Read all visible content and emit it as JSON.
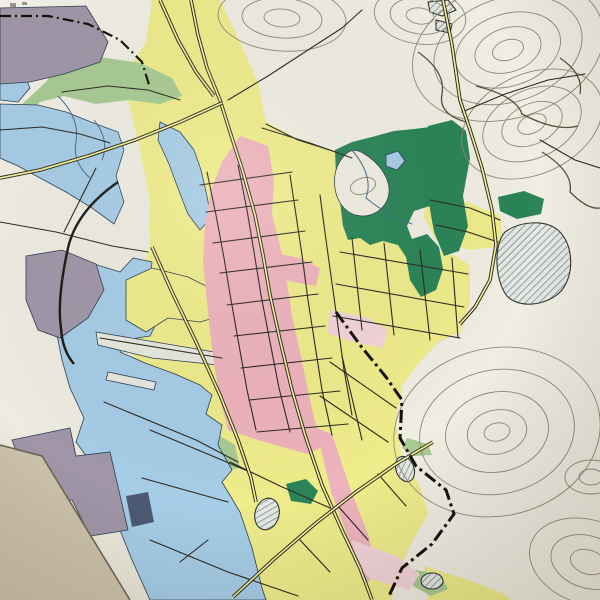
{
  "map": {
    "kind": "photographed paper city map (Japanese town plan)",
    "colors": {
      "paper": "#f0ede2",
      "residential_yellow": "#efec8b",
      "commercial_pink": "#eeb3bd",
      "faded_pink": "#f3d4da",
      "water_blue": "#a6cde7",
      "industrial_purple": "#a096a8",
      "dark_navy_block": "#4b5a72",
      "park_green": "#2a8457",
      "field_sage": "#a8cb92",
      "contour_grey": "#8d8a7a",
      "road_black": "#2b2820",
      "boundary_black": "#141208",
      "table_tan": "#cdc2ab",
      "grid_cyan": "#8fd2de",
      "label_ink": "#25221a"
    },
    "labels": [
      {
        "id": "ejiri-cho",
        "text": "江尻町",
        "x": 93,
        "y": 45,
        "dir": 7,
        "size": 12.5,
        "step": 22
      },
      {
        "id": "kendo-33",
        "text": "県道33",
        "x": 171,
        "y": 3,
        "dir": 38,
        "size": 8,
        "step": 8.5
      },
      {
        "id": "showa-cho",
        "text": "昭和町",
        "x": 107,
        "y": 170,
        "dir": -66,
        "size": 11.5,
        "step": 21
      },
      {
        "id": "yokotsu-cho",
        "text": "横津町",
        "x": 204,
        "y": 127,
        "dir": 55,
        "size": 11,
        "step": 12
      },
      {
        "id": "asahi-cho",
        "text": "旭町",
        "x": 211,
        "y": 164,
        "dir": 40,
        "size": 11,
        "step": 12
      },
      {
        "id": "tani-cho",
        "text": "谷町",
        "x": 267,
        "y": 148,
        "dir": 35,
        "size": 10.5,
        "step": 11
      },
      {
        "id": "kume-cho",
        "text": "久米町",
        "x": 172,
        "y": 246,
        "dir": -70,
        "size": 12,
        "step": 15
      },
      {
        "id": "muro-machi",
        "text": "室町",
        "x": 208,
        "y": 208,
        "dir": 25,
        "size": 9.5,
        "step": 10.5
      },
      {
        "id": "kyo-machi",
        "text": "京町",
        "x": 227,
        "y": 257,
        "dir": 30,
        "size": 11,
        "step": 12
      },
      {
        "id": "moto-machi",
        "text": "元町",
        "x": 258,
        "y": 298,
        "dir": 33,
        "size": 11,
        "step": 12
      },
      {
        "id": "hon-machi",
        "text": "本町",
        "x": 258,
        "y": 336,
        "dir": 31,
        "size": 11,
        "step": 12
      },
      {
        "id": "takara-machi",
        "text": "宝町",
        "x": 147,
        "y": 313,
        "dir": -8,
        "size": 10,
        "step": 12
      },
      {
        "id": "irifune-cho",
        "text": "入船町",
        "x": 127,
        "y": 324,
        "dir": -26,
        "size": 11.5,
        "step": 15
      },
      {
        "id": "chuo-cho",
        "text": "中央町",
        "x": 206,
        "y": 376,
        "dir": 76,
        "size": 12,
        "step": 15
      },
      {
        "id": "miyashita-cho",
        "text": "宮下町",
        "x": 253,
        "y": 421,
        "dir": 75,
        "size": 11.5,
        "step": 15
      },
      {
        "id": "shirogane-cho",
        "text": "白金町",
        "x": 296,
        "y": 443,
        "dir": 75,
        "size": 11.5,
        "step": 15
      },
      {
        "id": "bunkyo-cho",
        "text": "文京町",
        "x": 343,
        "y": 265,
        "dir": 75,
        "size": 11.5,
        "step": 14
      },
      {
        "id": "aoba-cho",
        "text": "青葉町",
        "x": 429,
        "y": 254,
        "dir": 78,
        "size": 10.5,
        "step": 13
      },
      {
        "id": "ikezono-cho",
        "text": "池園町",
        "x": 446,
        "y": 282,
        "dir": 78,
        "size": 9,
        "step": 10
      },
      {
        "id": "umee-cho",
        "text": "梅江町",
        "x": 437,
        "y": 186,
        "dir": -80,
        "size": 9.5,
        "step": 14
      },
      {
        "id": "oyabu-cho",
        "text": "大屋冨町",
        "x": 519,
        "y": 213,
        "dir": -110,
        "size": 10,
        "step": 15
      },
      {
        "id": "kamada-ike",
        "text": "鎌田池",
        "x": 525,
        "y": 241,
        "dir": 78,
        "size": 9.5,
        "step": 11,
        "halo": true
      },
      {
        "id": "fujimi-cho",
        "text": "富士見町",
        "x": 387,
        "y": 332,
        "dir": 80,
        "size": 11.5,
        "step": 13
      },
      {
        "id": "niihama-cho",
        "text": "新浜町",
        "x": 336,
        "y": 399,
        "dir": 76,
        "size": 11.5,
        "step": 14
      },
      {
        "id": "tsuno-yama",
        "text": "角山",
        "x": 461,
        "y": 412,
        "dir": 68,
        "size": 10,
        "step": 11,
        "halo": true
      },
      {
        "id": "hachiman-cho",
        "text": "八幡町",
        "x": 366,
        "y": 469,
        "dir": 75,
        "size": 11,
        "step": 13
      },
      {
        "id": "tokiwa-cho",
        "text": "常盤町",
        "x": 336,
        "y": 554,
        "dir": -80,
        "size": 11,
        "step": 14
      },
      {
        "id": "gobusho-cho",
        "text": "御供所町",
        "x": 194,
        "y": 583,
        "dir": -5,
        "size": 11.5,
        "step": 15
      },
      {
        "id": "chikko-cho",
        "text": "築港町",
        "x": 49,
        "y": 500,
        "dir": -100,
        "size": 11.5,
        "step": 16
      },
      {
        "id": "sakaideko-station",
        "text": "坂出港駅",
        "x": 56,
        "y": 330,
        "dir": 76,
        "size": 8.5,
        "step": 9.5,
        "halo": true
      },
      {
        "id": "kame-yama",
        "text": "亀山",
        "x": 350,
        "y": 176,
        "dir": 72,
        "size": 8.5,
        "step": 9.5,
        "halo": true
      },
      {
        "id": "grid-number-99",
        "text": "99",
        "x": 500,
        "y": 472,
        "dir": 0,
        "size": 9,
        "step": 8,
        "color": "#8fd2de"
      },
      {
        "id": "grid-number-66",
        "text": "66",
        "x": 578,
        "y": 345,
        "dir": 0,
        "size": 9,
        "step": 8,
        "color": "#8fd2de"
      }
    ],
    "symbols": [
      {
        "type": "temple",
        "glyph": "卍",
        "x": 288,
        "y": 28
      },
      {
        "type": "temple",
        "glyph": "卍",
        "x": 328,
        "y": 216
      },
      {
        "type": "temple",
        "glyph": "卍",
        "x": 345,
        "y": 490
      },
      {
        "type": "temple",
        "glyph": "卍",
        "x": 403,
        "y": 531
      },
      {
        "type": "temple",
        "glyph": "卍",
        "x": 417,
        "y": 525
      },
      {
        "type": "school",
        "glyph": "文",
        "x": 152,
        "y": 188
      },
      {
        "type": "school",
        "glyph": "文",
        "x": 277,
        "y": 213
      },
      {
        "type": "school",
        "glyph": "文",
        "x": 422,
        "y": 243
      },
      {
        "type": "school",
        "glyph": "文",
        "x": 423,
        "y": 272
      },
      {
        "type": "school",
        "glyph": "文",
        "x": 352,
        "y": 407
      },
      {
        "type": "school",
        "glyph": "文",
        "x": 282,
        "y": 405
      },
      {
        "type": "school",
        "glyph": "文",
        "x": 283,
        "y": 503
      },
      {
        "type": "city-office",
        "x": 231,
        "y": 241
      },
      {
        "type": "summit",
        "x": 530,
        "y": 120
      },
      {
        "type": "summit",
        "x": 497,
        "y": 430
      },
      {
        "type": "dot",
        "x": 366,
        "y": 196
      },
      {
        "type": "station",
        "x": 62,
        "y": 336,
        "rot": 78
      },
      {
        "type": "building",
        "x": 452,
        "y": 118
      },
      {
        "type": "building",
        "x": 459,
        "y": 127
      },
      {
        "type": "building",
        "x": 464,
        "y": 143
      },
      {
        "type": "building",
        "x": 468,
        "y": 152
      },
      {
        "type": "building",
        "x": 543,
        "y": 6
      },
      {
        "type": "building",
        "x": 552,
        "y": 12
      }
    ]
  }
}
